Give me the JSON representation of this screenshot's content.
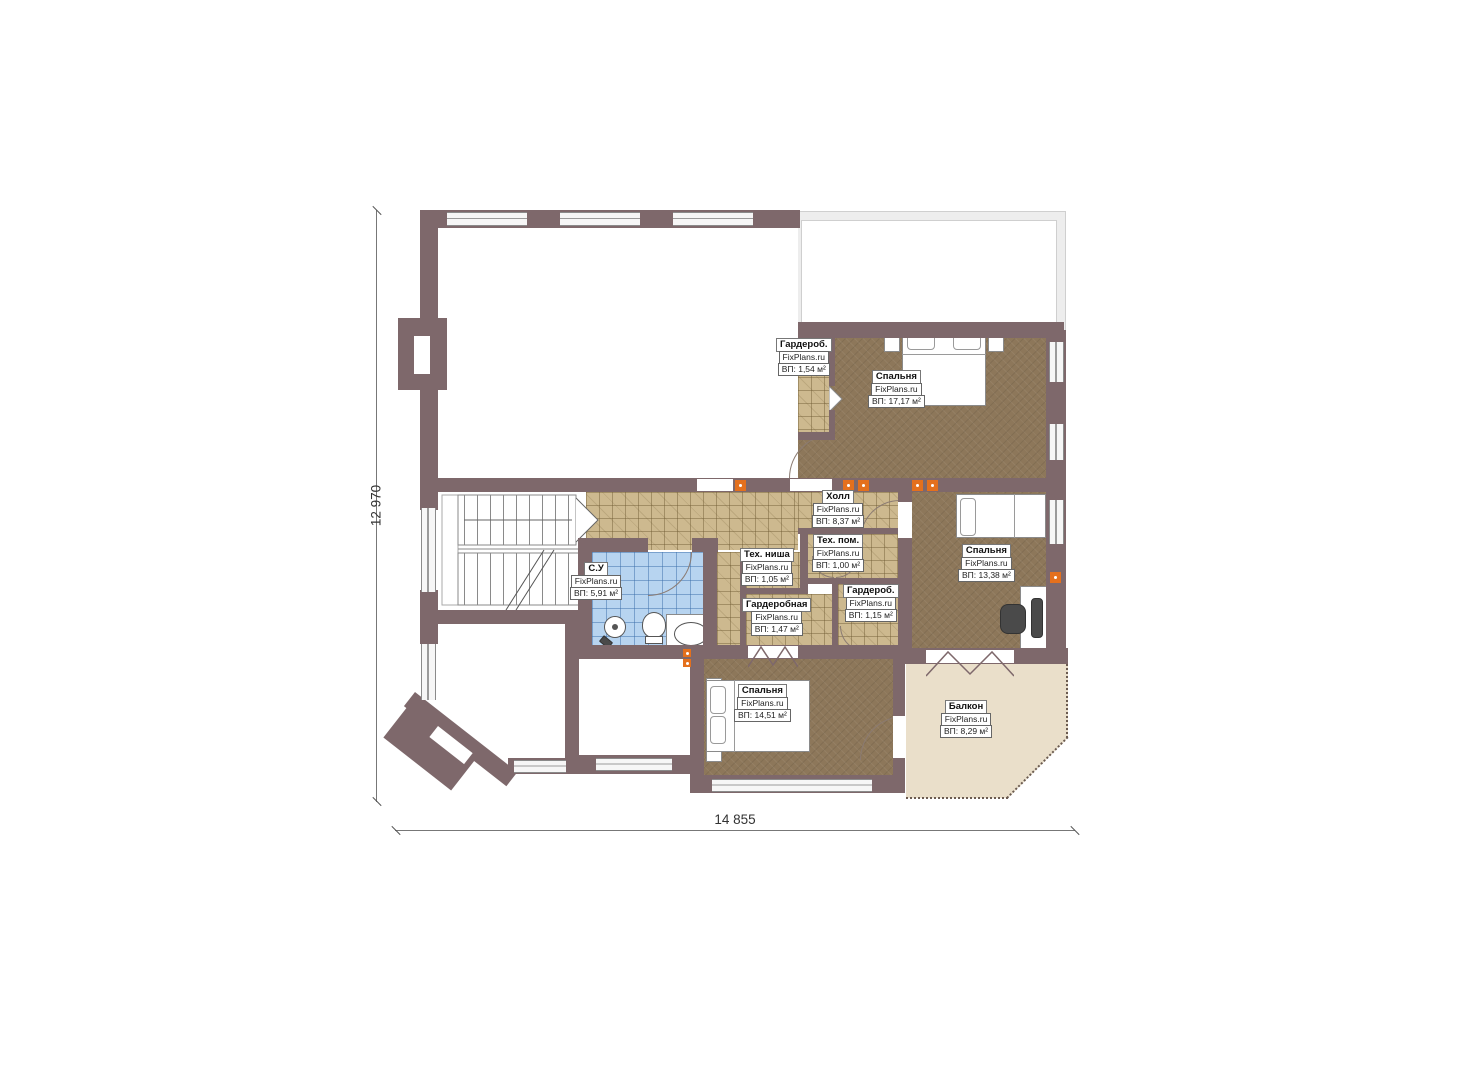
{
  "watermark": "FixPlans.ru",
  "dimensions": {
    "height_label": "12 970",
    "width_label": "14 855"
  },
  "rooms": [
    {
      "name": "Гардероб.",
      "area": "ВП: 1,54 м²"
    },
    {
      "name": "Спальня",
      "area": "ВП: 17,17 м²"
    },
    {
      "name": "Холл",
      "area": "ВП: 8,37 м²"
    },
    {
      "name": "Тех. ниша",
      "area": "ВП: 1,05 м²"
    },
    {
      "name": "Тех. пом.",
      "area": "ВП: 1,00 м²"
    },
    {
      "name": "Спальня",
      "area": "ВП: 13,38 м²"
    },
    {
      "name": "С.У",
      "area": "ВП: 5,91 м²"
    },
    {
      "name": "Гардеробная",
      "area": "ВП: 1,47 м²"
    },
    {
      "name": "Гардероб.",
      "area": "ВП: 1,15 м²"
    },
    {
      "name": "Спальня",
      "area": "ВП: 14,51 м²"
    },
    {
      "name": "Балкон",
      "area": "ВП: 8,29 м²"
    }
  ],
  "colors": {
    "wall": "#7e686b",
    "bedroom_floor": "#8d775a",
    "tile_floor": "#cdb98f",
    "bathroom_tile": "#b7d4f0",
    "balcony_floor": "#eadfca",
    "vent_accent": "#e4701d"
  }
}
